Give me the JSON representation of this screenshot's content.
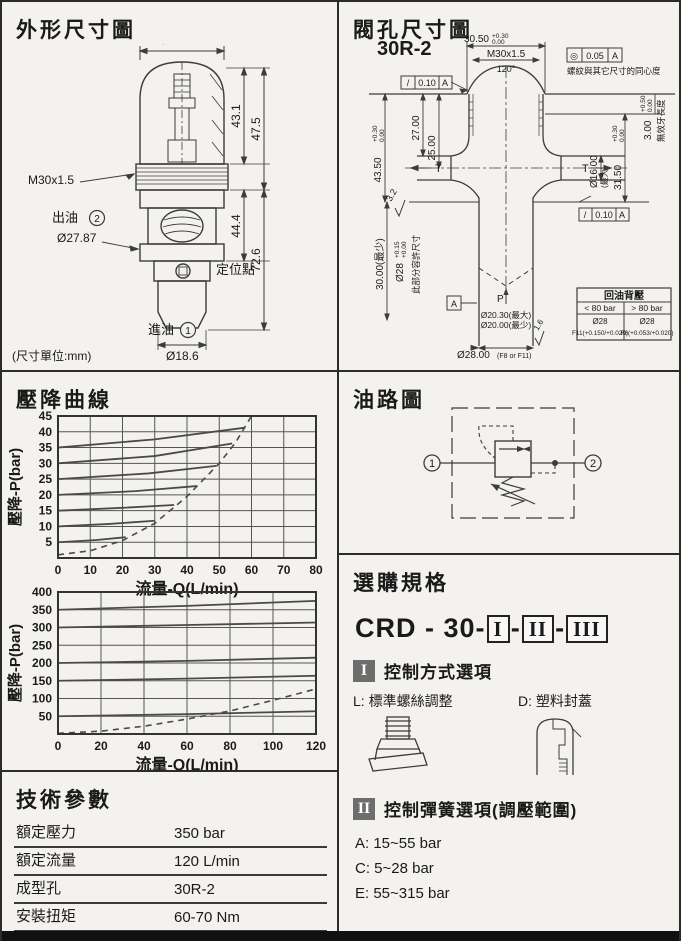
{
  "outline": {
    "title": "外形尺寸圖",
    "unit_note": "(尺寸單位:mm)",
    "dims": {
      "d31": "Ø31.00",
      "h431": "43.1",
      "h475": "47.5",
      "thread": "M30x1.5",
      "out_label": "出油",
      "out_no": "2",
      "d2787": "Ø27.87",
      "h444": "44.4",
      "h726": "72.6",
      "locating": "定位點",
      "in_label": "進油",
      "in_no": "1",
      "d186": "Ø18.6"
    }
  },
  "cavity": {
    "title": "閥孔尺寸圖",
    "code": "30R-2",
    "dims": {
      "w3050": "30.50",
      "w3050_tp": "+0.30",
      "w3050_tb": "0.00",
      "thread": "M30x1.5",
      "angle": "120°",
      "conc_sym": "◎",
      "conc_val": "0.05",
      "conc_datum": "A",
      "conc_note": "螺紋與其它尺寸的同心度",
      "flat_sym": "/",
      "flat_val": "0.10",
      "flat_datum": "A",
      "t300": "3.00",
      "t300_tp": "+0.50",
      "t300_tb": "0.00",
      "t300_note": "無效牙長度",
      "h4350": "43.50",
      "h4350_tp": "+0.30",
      "h4350_tb": "0.00",
      "h2700": "27.00",
      "h2500": "25.00",
      "t": "T",
      "d16": "Ø16.00",
      "d16_note": "(最大)",
      "h3150": "31.50",
      "h3150_tp": "+0.30",
      "h3150_tb": "0.00",
      "rough32": "3.2",
      "rough16": "1.6",
      "h3000": "30.00(最少)",
      "d28": "Ø28",
      "d28_tp": "+0.15",
      "d28_tb": "+0.00",
      "d28_note": "此部分容許尺寸",
      "datum": "A",
      "p": "P",
      "d2030": "Ø20.30(最大)",
      "d2000": "Ø20.00(最少)",
      "d2800": "Ø28.00",
      "d2800_fit": "(F8 or F11)"
    },
    "table": {
      "title": "回油背壓",
      "col_lt": "< 80 bar",
      "col_gt": "> 80 bar",
      "lt_d": "Ø28",
      "lt_fit": "F11(+0.150/+0.020)",
      "gt_d": "Ø28",
      "gt_fit": "F8(+0.053/+0.020)"
    }
  },
  "curves": {
    "title": "壓降曲線"
  },
  "circuit": {
    "title": "油路圖",
    "port1": "1",
    "port2": "2"
  },
  "ordering": {
    "title": "選購規格",
    "code_prefix": "CRD - 30-",
    "dash": "-",
    "seg1": "I",
    "seg2": "II",
    "seg3": "III",
    "s1": {
      "num": "I",
      "title": "控制方式選項",
      "optL": "L: 標準螺絲調整",
      "optD": "D: 塑料封蓋"
    },
    "s2": {
      "num": "II",
      "title": "控制彈簧選項(調壓範圍)",
      "opts": [
        "A: 15~55  bar",
        "C:  5~28  bar",
        "E: 55~315 bar"
      ]
    },
    "s3": {
      "num": "III",
      "title": "油封材質",
      "optN": "N:  Buna-N",
      "optV": "V:  Viton"
    }
  },
  "specs": {
    "title": "技術參數",
    "rows": [
      {
        "label": "額定壓力",
        "value": "350 bar"
      },
      {
        "label": "額定流量",
        "value": "120 L/min"
      },
      {
        "label": "成型孔",
        "value": "30R-2"
      },
      {
        "label": "安裝扭矩",
        "value": "60-70 Nm"
      },
      {
        "label": "重量",
        "value": "0.3 Kg"
      }
    ]
  },
  "chart_data": [
    {
      "type": "line",
      "title": "壓降曲線 (low pressure settings)",
      "xlabel": "流量-Q(L/min)",
      "ylabel": "壓降-P(bar)",
      "xlim": [
        0,
        80
      ],
      "ylim": [
        0,
        45
      ],
      "xticks": [
        0,
        10,
        20,
        30,
        40,
        50,
        60,
        70,
        80
      ],
      "yticks": [
        5,
        10,
        15,
        20,
        25,
        30,
        35,
        40,
        45
      ],
      "grid": true,
      "legend": "none",
      "series": [
        {
          "name": "setting 5 bar",
          "style": "solid",
          "points": [
            [
              0,
              5
            ],
            [
              12,
              5.7
            ],
            [
              21,
              6.6
            ]
          ]
        },
        {
          "name": "setting 10 bar",
          "style": "solid",
          "points": [
            [
              0,
              10
            ],
            [
              16,
              10.8
            ],
            [
              30,
              11.8
            ]
          ]
        },
        {
          "name": "setting 15 bar",
          "style": "solid",
          "points": [
            [
              0,
              15
            ],
            [
              20,
              15.9
            ],
            [
              36,
              16.8
            ]
          ]
        },
        {
          "name": "setting 20 bar",
          "style": "solid",
          "points": [
            [
              0,
              20
            ],
            [
              24,
              21.2
            ],
            [
              43,
              22.8
            ]
          ]
        },
        {
          "name": "setting 25 bar",
          "style": "solid",
          "points": [
            [
              0,
              25
            ],
            [
              28,
              26.8
            ],
            [
              49,
              29.2
            ]
          ]
        },
        {
          "name": "setting 30 bar",
          "style": "solid",
          "points": [
            [
              0,
              30
            ],
            [
              30,
              32.3
            ],
            [
              54,
              36.3
            ]
          ]
        },
        {
          "name": "setting 35 bar",
          "style": "solid",
          "points": [
            [
              0,
              35
            ],
            [
              30,
              37.6
            ],
            [
              58,
              41.3
            ]
          ]
        }
      ],
      "envelope": {
        "name": "max pressure-drop envelope",
        "style": "dashed",
        "points": [
          [
            0,
            1
          ],
          [
            10,
            2.3
          ],
          [
            20,
            5.5
          ],
          [
            30,
            11
          ],
          [
            40,
            19.5
          ],
          [
            50,
            30
          ],
          [
            55,
            36.5
          ],
          [
            60,
            45
          ]
        ]
      }
    },
    {
      "type": "line",
      "title": "壓降曲線 (high pressure settings)",
      "xlabel": "流量-Q(L/min)",
      "ylabel": "壓降-P(bar)",
      "xlim": [
        0,
        120
      ],
      "ylim": [
        0,
        400
      ],
      "xticks": [
        0,
        20,
        40,
        60,
        80,
        100,
        120
      ],
      "yticks": [
        50,
        100,
        150,
        200,
        250,
        300,
        350,
        400
      ],
      "grid": true,
      "legend": "none",
      "series": [
        {
          "name": "setting 50 bar",
          "style": "solid",
          "points": [
            [
              0,
              50
            ],
            [
              60,
              56
            ],
            [
              120,
              64
            ]
          ]
        },
        {
          "name": "setting 150 bar",
          "style": "solid",
          "points": [
            [
              0,
              150
            ],
            [
              60,
              156
            ],
            [
              120,
              164
            ]
          ]
        },
        {
          "name": "setting 200 bar",
          "style": "solid",
          "points": [
            [
              0,
              200
            ],
            [
              60,
              206
            ],
            [
              120,
              215
            ]
          ]
        },
        {
          "name": "setting 300 bar",
          "style": "solid",
          "points": [
            [
              0,
              300
            ],
            [
              60,
              307
            ],
            [
              120,
              314
            ]
          ]
        },
        {
          "name": "setting 350 bar",
          "style": "solid",
          "points": [
            [
              0,
              350
            ],
            [
              60,
              361
            ],
            [
              120,
              375
            ]
          ]
        }
      ],
      "envelope": {
        "name": "max pressure-drop envelope",
        "style": "dashed",
        "points": [
          [
            0,
            2
          ],
          [
            20,
            8
          ],
          [
            40,
            22
          ],
          [
            60,
            42
          ],
          [
            80,
            65
          ],
          [
            100,
            95
          ],
          [
            120,
            127
          ]
        ]
      }
    }
  ]
}
